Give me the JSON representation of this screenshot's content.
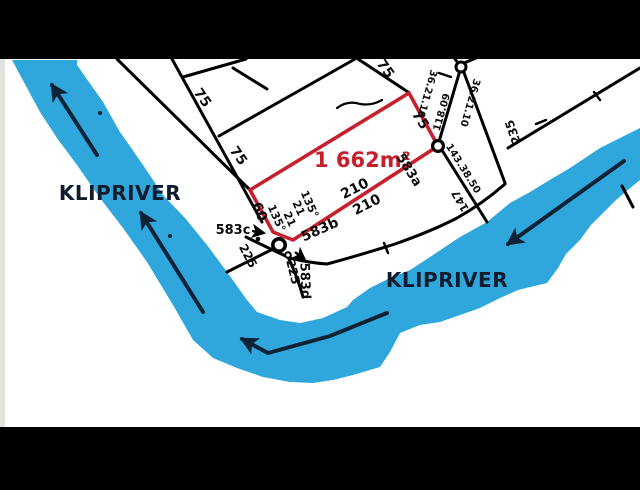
{
  "colors": {
    "river": "#2FA7DD",
    "plot_outline": "#C6202C",
    "survey_lines": "#000000",
    "flow_arrows": "#0D2235",
    "film_bars": "#000000",
    "paper": "#FFFFFF"
  },
  "river": {
    "name_left": "KLIPRIVER",
    "name_right": "KLIPRIVER"
  },
  "plot": {
    "area_label": "1 662m²"
  },
  "erven": {
    "a": "583a",
    "b": "583b",
    "c": "583c",
    "d": "583d"
  },
  "dimensions": {
    "seventy_five_1": "75",
    "seventy_five_2": "75",
    "seventy_five_3": "75",
    "seventy_five_4": "75",
    "sixty": "60",
    "two_ten_1": "210",
    "two_ten_2": "210",
    "two_two_five_1": "225",
    "two_two_five_2": "225",
    "two_three_five": "235",
    "one_four_seven": "147",
    "twenty_one_1": "21",
    "twenty_one_2": "21",
    "angle_135_1": "135°",
    "angle_135_2": "135°",
    "bearing_36_1": "36.21.10",
    "bearing_36_2": "36.21.10",
    "bearing_143": "143.38.50",
    "dist_118": "118.09"
  }
}
